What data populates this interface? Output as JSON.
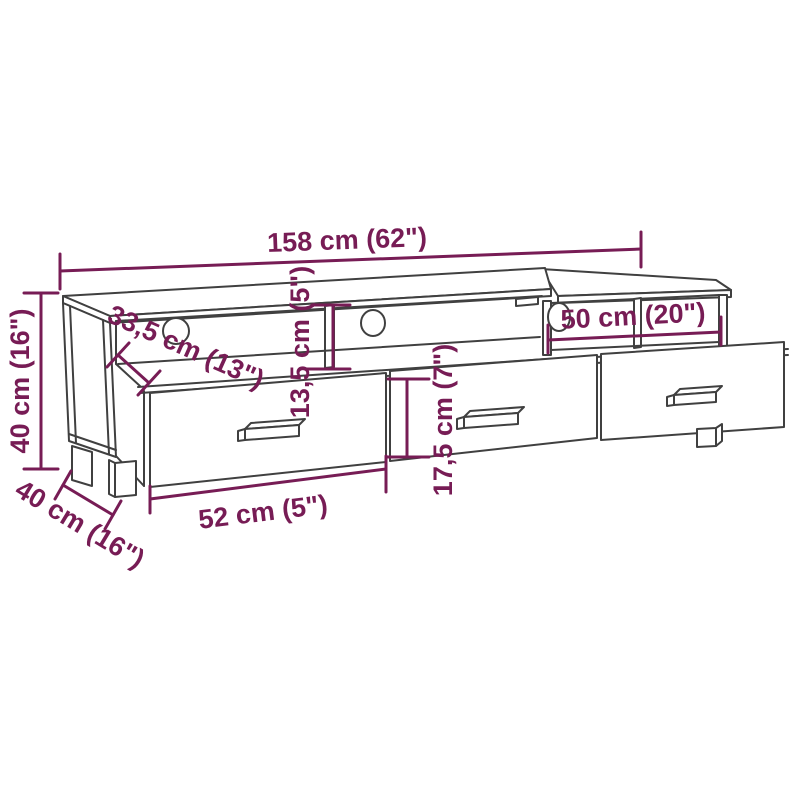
{
  "canvas": {
    "background": "#ffffff",
    "drawing_color": "#404040",
    "dimension_color": "#771c55"
  },
  "diagram": {
    "title": "TV stand dimension diagram",
    "subject": "TV cabinet with 3 open compartments, 3 cable holes and 3 drawers",
    "labels": {
      "overall_width": "158 cm (62\")",
      "overall_height": "40 cm (16\")",
      "overall_depth": "40 cm (16\")",
      "top_shelf_depth": "33,5 cm (13\")",
      "shelf_opening_height": "13,5 cm (5\")",
      "drawer_front_height": "17,5 cm (7\")",
      "right_shelf_width": "50 cm (20\")",
      "drawer_width": "52 cm (5\")"
    },
    "features": {
      "drawers": 3,
      "open_compartments": 3,
      "cable_holes": 3
    }
  }
}
